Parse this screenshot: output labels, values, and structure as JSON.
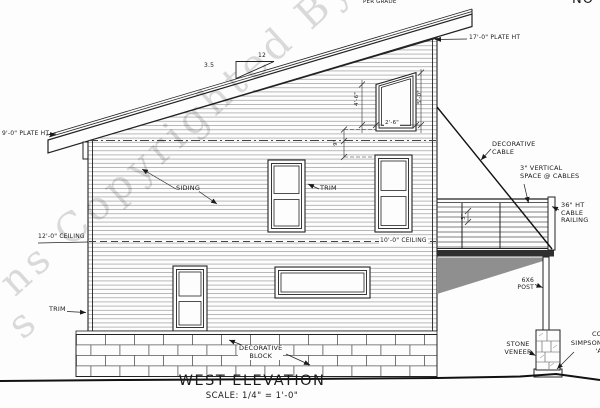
{
  "watermark": {
    "line": "ns Copyrighted By Leg",
    "fragment": "s"
  },
  "notes": {
    "per_grade": "PER GRADE",
    "corner_partial": "NO"
  },
  "roof": {
    "plate_high": "17'-0\" PLATE HT",
    "plate_low": "9'-0\" PLATE HT",
    "slope_run": "12",
    "slope_rise": "3.5"
  },
  "wall": {
    "siding": "SIDING",
    "trim_upper": "TRIM",
    "trim_lower": "TRIM",
    "ceiling_left": "12'-0\" CEILING",
    "ceiling_right": "10'-0\" CEILING"
  },
  "dims": {
    "window_width": "2'-6\"",
    "window_left_height": "4'-6\"",
    "window_right_height": "5'-0\"",
    "gap": "9\"",
    "cable_space": "3\""
  },
  "deck": {
    "decorative_cable_1": "DECORATIVE",
    "decorative_cable_2": "CABLE",
    "space_1": "3\" VERTICAL",
    "space_2": "SPACE @ CABLES",
    "rail_1": "36\" HT",
    "rail_2": "CABLE",
    "rail_3": "RAILING",
    "post_1": "6X6",
    "post_2": "POST",
    "stone_1": "STONE",
    "stone_2": "VENEER",
    "simpson_1": "CO",
    "simpson_2": "SIMPSON",
    "simpson_3": "'A"
  },
  "foundation": {
    "block_1": "DECORATIVE",
    "block_2": "BLOCK"
  },
  "titleblock": {
    "title": "WEST ELEVATION",
    "scale": "SCALE: 1/4\" = 1'-0\""
  },
  "colors": {
    "line": "#1a1a1a",
    "siding_line": "#9a9a9a",
    "deck_shadow": "#8f8f8f",
    "deck_beam": "#2f2f2f",
    "watermark": "rgba(0,0,0,0.14)"
  }
}
